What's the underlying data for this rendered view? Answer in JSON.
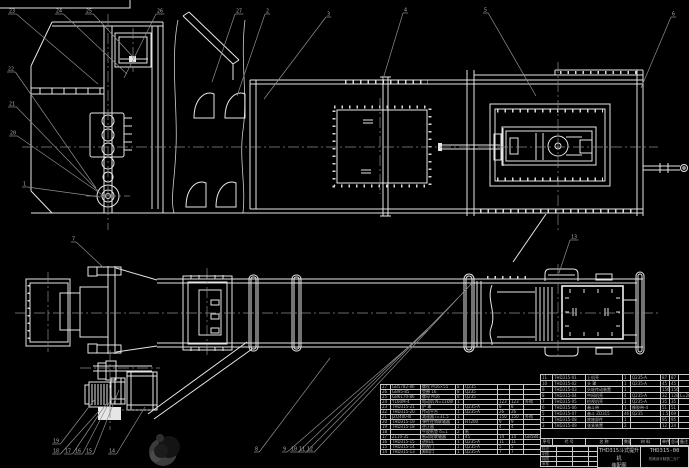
{
  "drawing": {
    "title": "THD315斗式提升机",
    "subtitle": "装配图",
    "drawing_no": "THD315-00",
    "company": "机械设计制造二分厂"
  },
  "parts_table": {
    "headers": [
      "序号",
      "代  号",
      "名  称",
      "数量",
      "材  料",
      "单件",
      "总计",
      "备注"
    ],
    "weight_label": "重量",
    "left_rows": [
      [
        "27",
        "GB5782-86",
        "螺栓 M16×55",
        "8",
        "Q235",
        "",
        "",
        ""
      ],
      [
        "26",
        "GB95-85",
        "垫圈 16",
        "8",
        "Q235",
        "",
        "",
        ""
      ],
      [
        "25",
        "GB6170-86",
        "螺母 M16",
        "8",
        "Q235",
        "",
        "",
        ""
      ],
      [
        "24",
        "Y160M-4",
        "电动机 N=11kW",
        "1",
        "",
        "123",
        "123",
        "外购"
      ],
      [
        "23",
        "THD315-21",
        "护  罩",
        "1",
        "Q235-A",
        "8",
        "8",
        ""
      ],
      [
        "22",
        "THD315-20",
        "传动平台",
        "1",
        "Q235-A",
        "26",
        "26",
        ""
      ],
      [
        "21",
        "JZQ400-Ⅲ",
        "减速器 i=31.5",
        "1",
        "",
        "150",
        "150",
        "外购"
      ],
      [
        "20",
        "THD315-19",
        "弹性柱销联轴器",
        "1",
        "HT200",
        "9",
        "9",
        ""
      ],
      [
        "19",
        "THD315-18",
        "逆止器",
        "1",
        "",
        "4",
        "4",
        ""
      ],
      [
        "18",
        "",
        "牛皮纸垫 δ=1",
        "2",
        "纸",
        "",
        "",
        ""
      ],
      [
        "17",
        "ZL10-35",
        "制动轮联轴器",
        "1",
        "45",
        "14",
        "14",
        "GB5843"
      ],
      [
        "16",
        "THD315-15",
        "进料斗",
        "1",
        "Q235-A",
        "11",
        "11",
        ""
      ],
      [
        "15",
        "THD315-14",
        "检视门",
        "1",
        "Q235-A",
        "5",
        "5",
        ""
      ],
      [
        "14",
        "THD315-13",
        "卸料口",
        "1",
        "Q235-A",
        "7",
        "7",
        ""
      ]
    ],
    "right_rows": [
      [
        "11",
        "THD315-01",
        "上机壳",
        "1",
        "Q235-A",
        "87",
        "87",
        ""
      ],
      [
        "10",
        "THD315-02",
        "头  罩",
        "1",
        "Q235-A",
        "45",
        "45",
        ""
      ],
      [
        "9",
        "THD315-03",
        "头轮传动装置",
        "1",
        "",
        "156",
        "156",
        ""
      ],
      [
        "8",
        "THD315-04",
        "中间机壳",
        "4",
        "Q235-A",
        "32",
        "128",
        "L=2000"
      ],
      [
        "7",
        "THD315-05",
        "检视机壳",
        "1",
        "Q235-A",
        "35",
        "35",
        ""
      ],
      [
        "6",
        "THD315-06",
        "畚斗带",
        "1",
        "橡胶带-4",
        "51",
        "51",
        ""
      ],
      [
        "5",
        "THD315-07",
        "畚斗 ZD315",
        "46",
        "Q235",
        "1.5",
        "69",
        ""
      ],
      [
        "4",
        "THD315-08",
        "底座部件",
        "1",
        "",
        "95",
        "95",
        ""
      ],
      [
        "3",
        "THD315-09",
        "张紧装置",
        "2",
        "",
        "12",
        "24",
        ""
      ]
    ]
  },
  "title_block": {
    "sign_labels": [
      "标记",
      "制图",
      "描图",
      "审核"
    ]
  },
  "callouts": [
    {
      "n": "23",
      "x": 9,
      "y": 8,
      "tx": 98,
      "ty": 84
    },
    {
      "n": "24",
      "x": 56,
      "y": 8,
      "tx": 127,
      "ty": 74
    },
    {
      "n": "25",
      "x": 86,
      "y": 8,
      "tx": 133,
      "ty": 57
    },
    {
      "n": "26",
      "x": 157,
      "y": 8,
      "tx": 124,
      "ty": 78
    },
    {
      "n": "27",
      "x": 236,
      "y": 8,
      "tx": 212,
      "ty": 82
    },
    {
      "n": "2",
      "x": 266,
      "y": 8,
      "tx": 237,
      "ty": 96
    },
    {
      "n": "3",
      "x": 327,
      "y": 11,
      "tx": 264,
      "ty": 99
    },
    {
      "n": "4",
      "x": 404,
      "y": 7,
      "tx": 383,
      "ty": 79
    },
    {
      "n": "5",
      "x": 484,
      "y": 7,
      "tx": 536,
      "ty": 96
    },
    {
      "n": "6",
      "x": 672,
      "y": 11,
      "tx": 641,
      "ty": 88
    },
    {
      "n": "22",
      "x": 8,
      "y": 66,
      "tx": 96,
      "ty": 188
    },
    {
      "n": "21",
      "x": 9,
      "y": 101,
      "tx": 99,
      "ty": 192
    },
    {
      "n": "20",
      "x": 10,
      "y": 130,
      "tx": 104,
      "ty": 196
    },
    {
      "n": "1",
      "x": 23,
      "y": 181,
      "tx": 100,
      "ty": 197
    },
    {
      "n": "7",
      "x": 72,
      "y": 236,
      "tx": 104,
      "ty": 268
    },
    {
      "n": "19",
      "x": 53,
      "y": 438,
      "tx": 95,
      "ty": 399
    },
    {
      "n": "18",
      "x": 53,
      "y": 448,
      "tx": 99,
      "ty": 411
    },
    {
      "n": "17",
      "x": 65,
      "y": 448,
      "tx": 106,
      "ty": 404
    },
    {
      "n": "16",
      "x": 75,
      "y": 448,
      "tx": 112,
      "ty": 397
    },
    {
      "n": "15",
      "x": 86,
      "y": 448,
      "tx": 119,
      "ty": 390
    },
    {
      "n": "14",
      "x": 109,
      "y": 448,
      "tx": 145,
      "ty": 407
    },
    {
      "n": "8",
      "x": 255,
      "y": 446,
      "tx": 330,
      "ty": 358
    },
    {
      "n": "9",
      "x": 283,
      "y": 446,
      "tx": 428,
      "ty": 330
    },
    {
      "n": "10",
      "x": 291,
      "y": 446,
      "tx": 443,
      "ty": 314
    },
    {
      "n": "11",
      "x": 299,
      "y": 446,
      "tx": 458,
      "ty": 298
    },
    {
      "n": "12",
      "x": 307,
      "y": 446,
      "tx": 473,
      "ty": 282
    },
    {
      "n": "13",
      "x": 571,
      "y": 234,
      "tx": 559,
      "ty": 273
    }
  ]
}
